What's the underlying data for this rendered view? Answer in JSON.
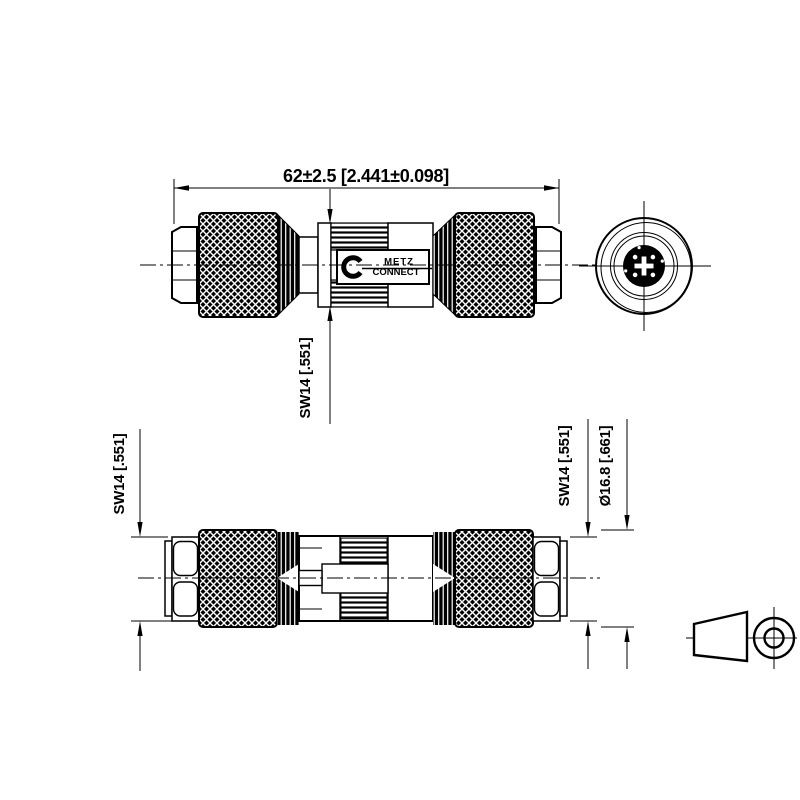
{
  "page": {
    "background": "#ffffff",
    "ink": "#000000",
    "description_labels": {
      "brand": {
        "line1": "METZ",
        "line2": "CONNECT"
      }
    }
  },
  "dimensions": {
    "overall_length": "62±2.5 [2.441±0.098]",
    "wrench_size_top_view": "SW14 [.551]",
    "wrench_size_bottom_left": "SW14 [.551]",
    "wrench_size_bottom_right": "SW14 [.551]",
    "knurl_diameter": "Ø16.8 [.661]"
  }
}
